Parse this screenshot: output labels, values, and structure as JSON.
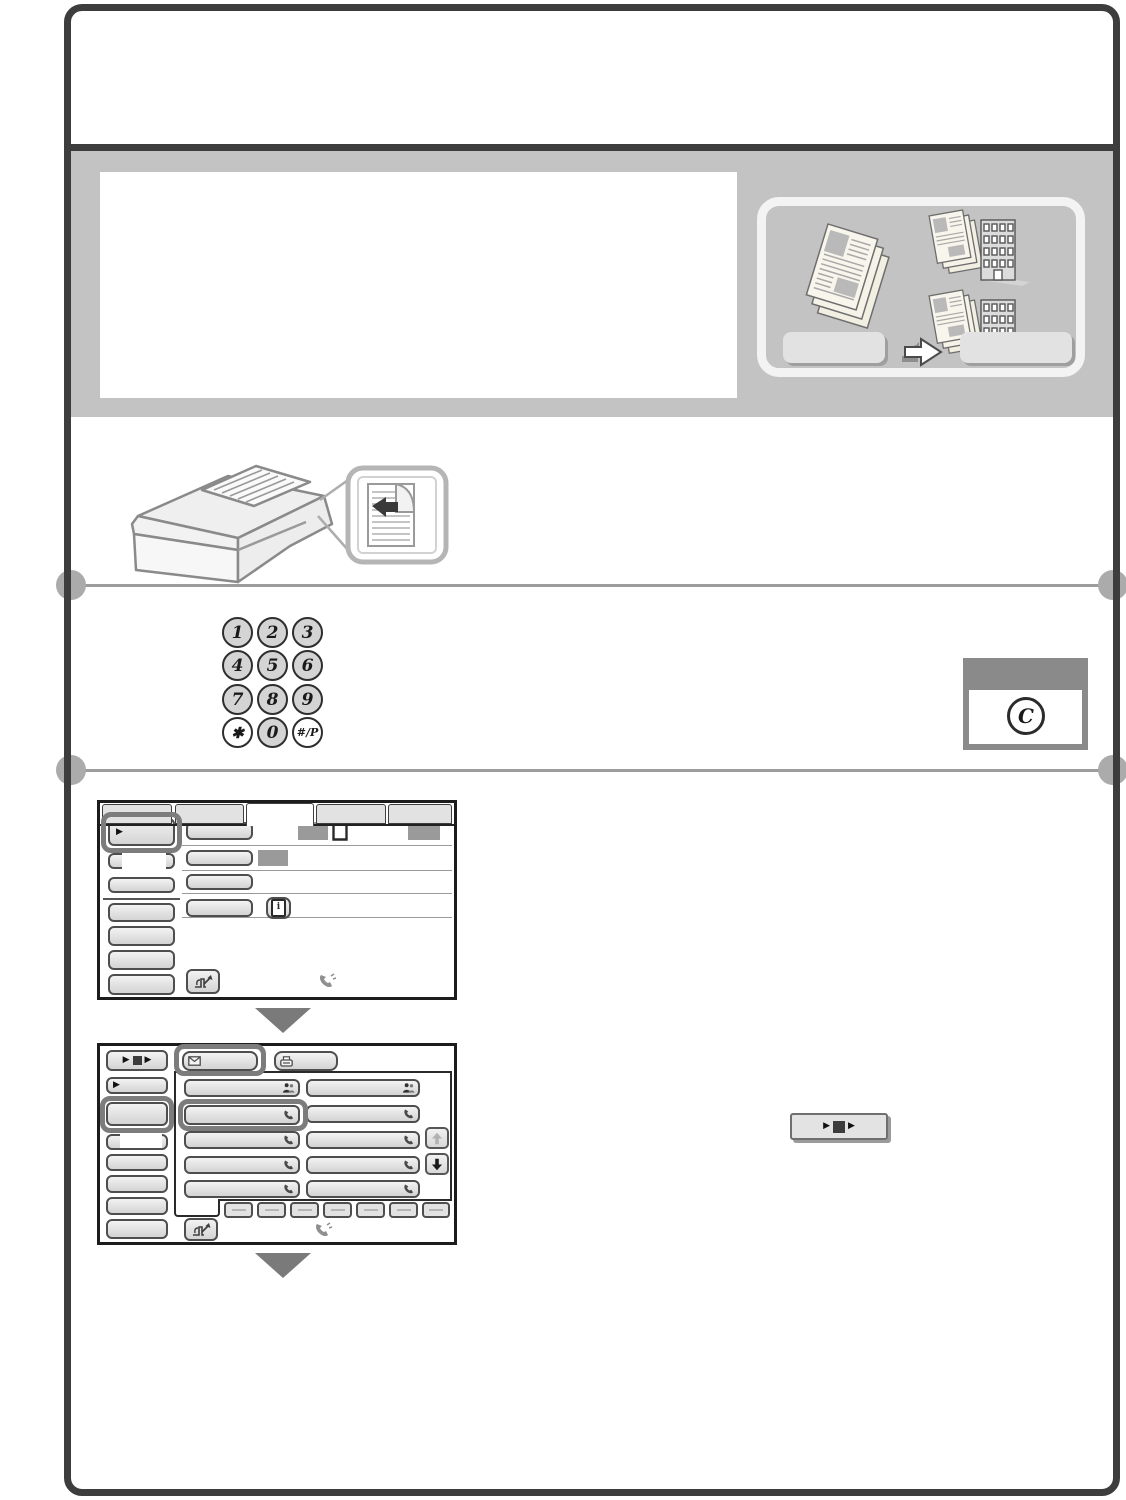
{
  "device_panel": {
    "keypad_keys": [
      "1",
      "2",
      "3",
      "4",
      "5",
      "6",
      "7",
      "8",
      "9",
      "✱",
      "0",
      "#/P"
    ],
    "clear_key_label": "C"
  },
  "glyphs": {
    "play": "▶"
  },
  "colors": {
    "frame": "#3d3d3d",
    "banner_bg": "#c3c3c3",
    "highlight_border": "#7c7c7c",
    "redaction_gray": "#9a9a9a",
    "button_face": "#e3e3e3",
    "rule_gray": "#9c9c9c"
  },
  "icons": {
    "address_tab": "envelope-icon",
    "fax_tab": "fax-machine-icon",
    "group_key": "group-people-icon",
    "one_touch_key": "phone-handset-icon",
    "scroll_up": "up-arrow-icon",
    "scroll_down": "down-arrow-icon",
    "detail": "info-icon",
    "direct_entry": "hand-pen-icon",
    "speaker": "phone-check-icon",
    "original_doc": "document-outline-icon",
    "job_status": "play-stop-play-icon"
  }
}
